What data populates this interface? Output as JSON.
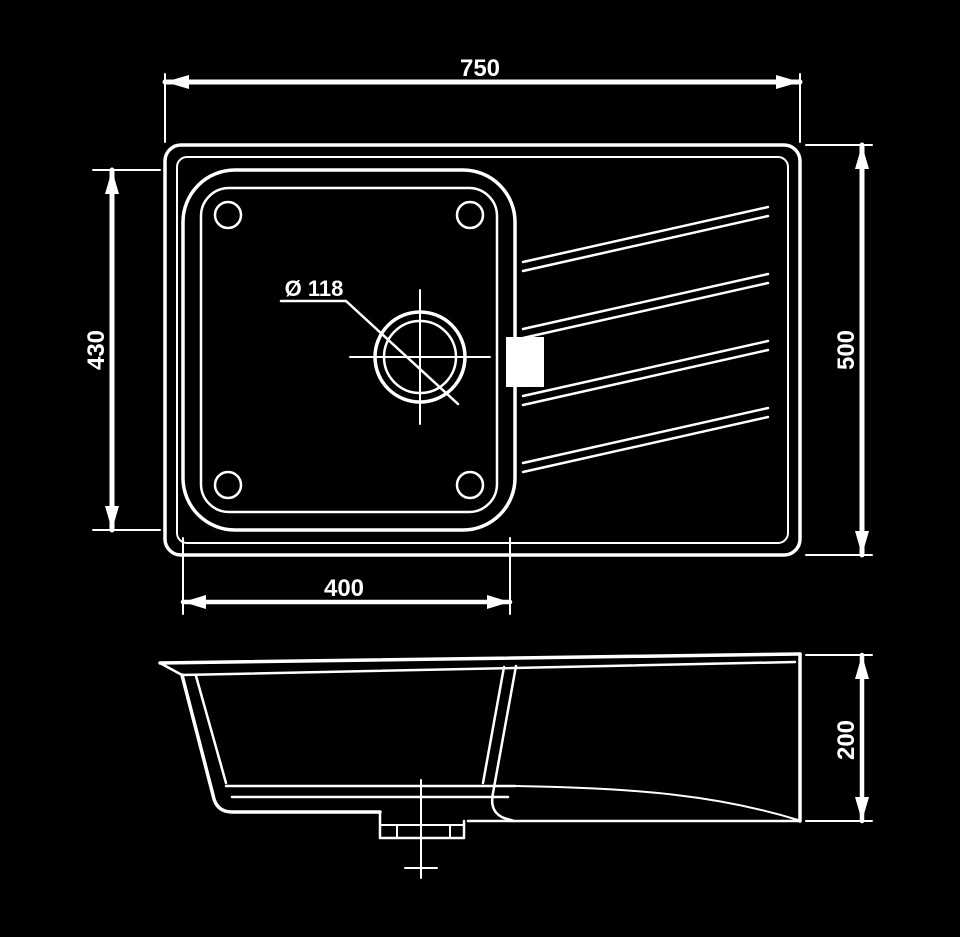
{
  "colors": {
    "background": "#000000",
    "line": "#ffffff",
    "text": "#ffffff"
  },
  "drawing": {
    "dimensions": {
      "overall_width": "750",
      "bowl_length": "430",
      "overall_depth": "500",
      "bowl_width": "400",
      "drain_diameter": "Ø 118",
      "bowl_depth": "200"
    }
  }
}
